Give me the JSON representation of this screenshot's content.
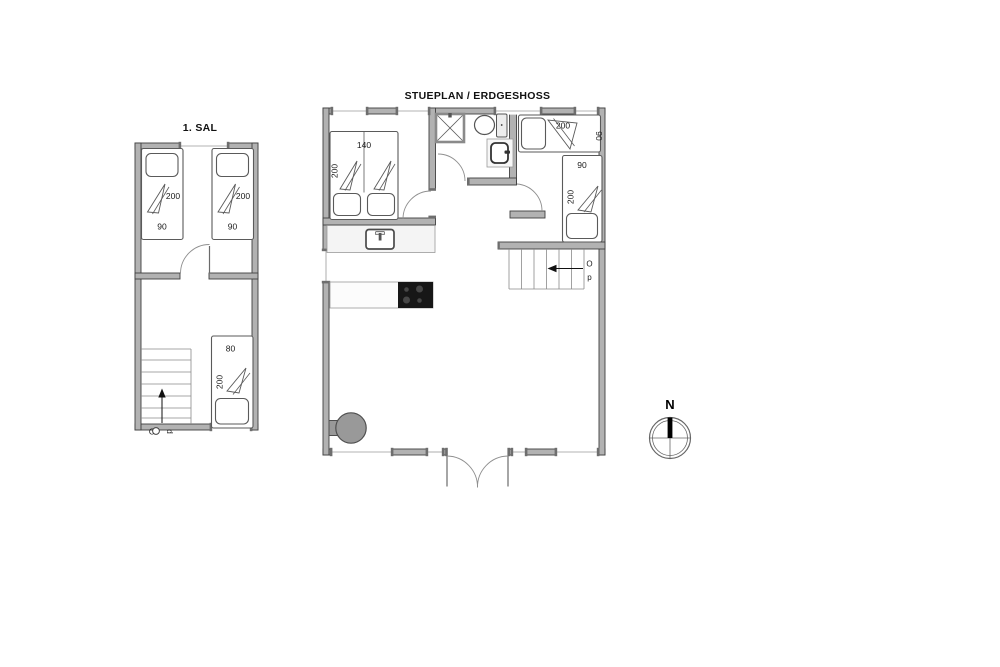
{
  "upper": {
    "title": "1. SAL",
    "beds": [
      {
        "length": "200",
        "width": "90"
      },
      {
        "length": "200",
        "width": "90"
      },
      {
        "width": "80",
        "length": "200"
      }
    ],
    "stair_o": "O",
    "stair_p": "p"
  },
  "ground": {
    "title": "STUEPLAN / ERDGESHOSS",
    "double_bed": {
      "width": "140",
      "length": "200"
    },
    "single_beds": [
      {
        "length": "200",
        "width": "90"
      },
      {
        "width": "90",
        "length": "200"
      }
    ],
    "stairs": {
      "o": "O",
      "p": "p"
    }
  },
  "compass": {
    "north": "N"
  },
  "colors": {
    "wall": "#b2b2b2",
    "wall_edge": "#3f3f3f",
    "furniture_line": "#5a5a5a",
    "cooktop": "#171717",
    "stove": "#999999",
    "counter": "#f4f4f4"
  }
}
